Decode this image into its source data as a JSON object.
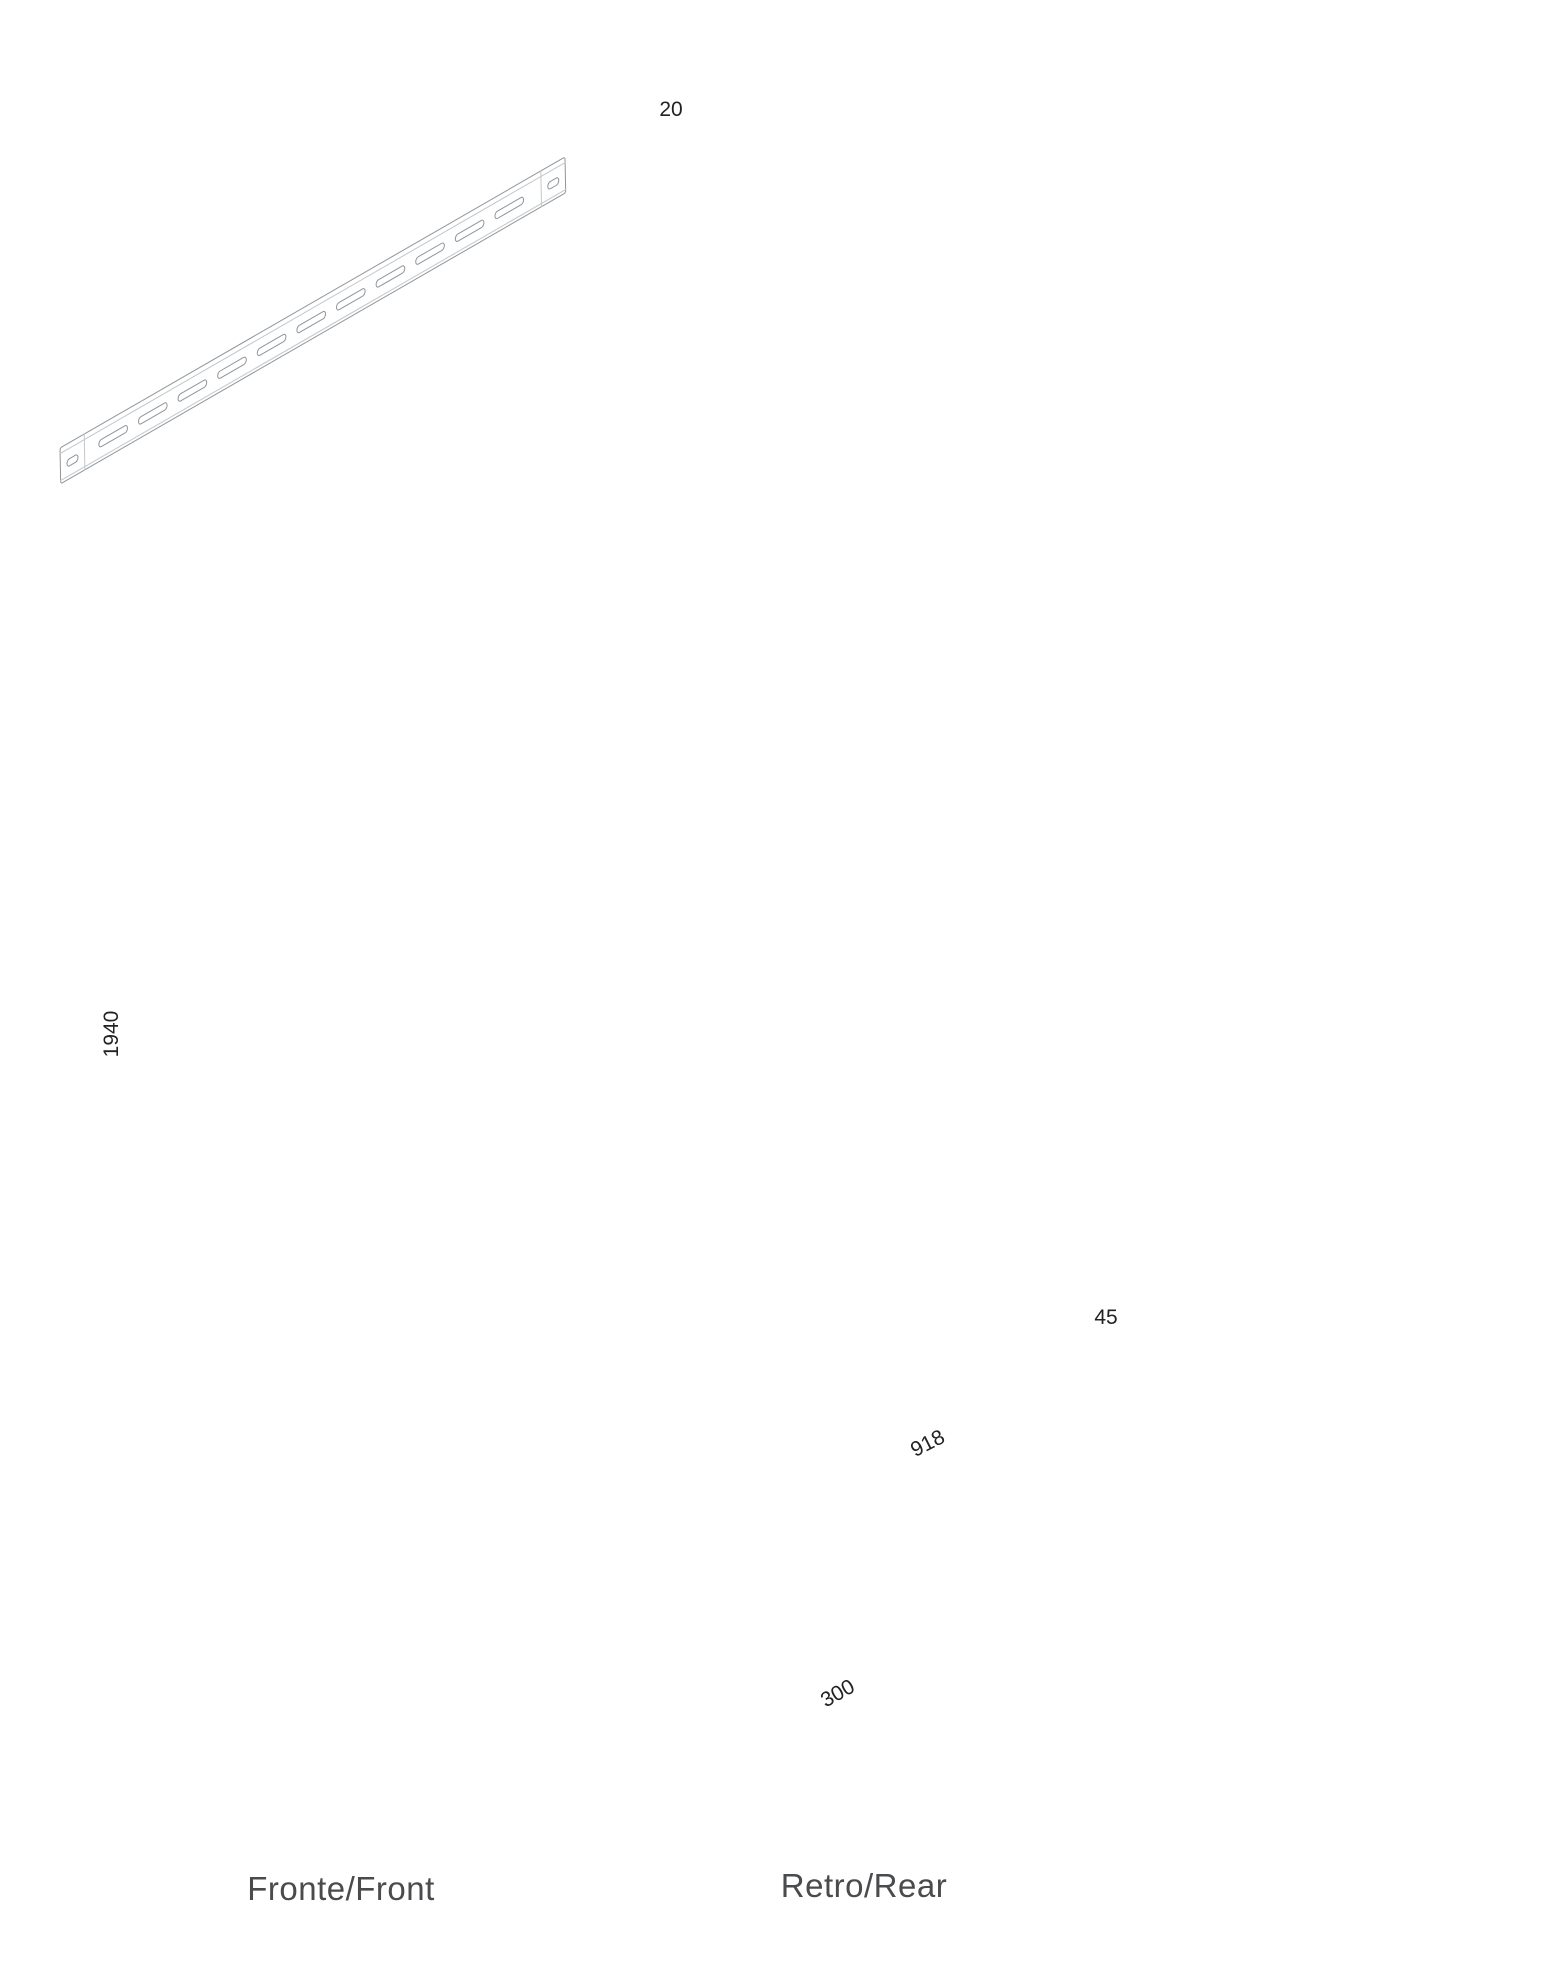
{
  "labels": {
    "front_caption": "Fronte/Front",
    "rear_caption": "Retro/Rear"
  },
  "dimensions": {
    "panel_height": "1940",
    "flange_depth": "20",
    "rail_height": "45",
    "rail_length": "918",
    "panel_width": "300"
  },
  "colors": {
    "line": "#8e959b",
    "light": "#c3c7ca",
    "ghost": "#ccd0d3",
    "dim": "#b2b6ba",
    "arrow": "#9b9b9b",
    "text": "#212224",
    "label": "#4a4b4d",
    "background": "#ffffff"
  }
}
